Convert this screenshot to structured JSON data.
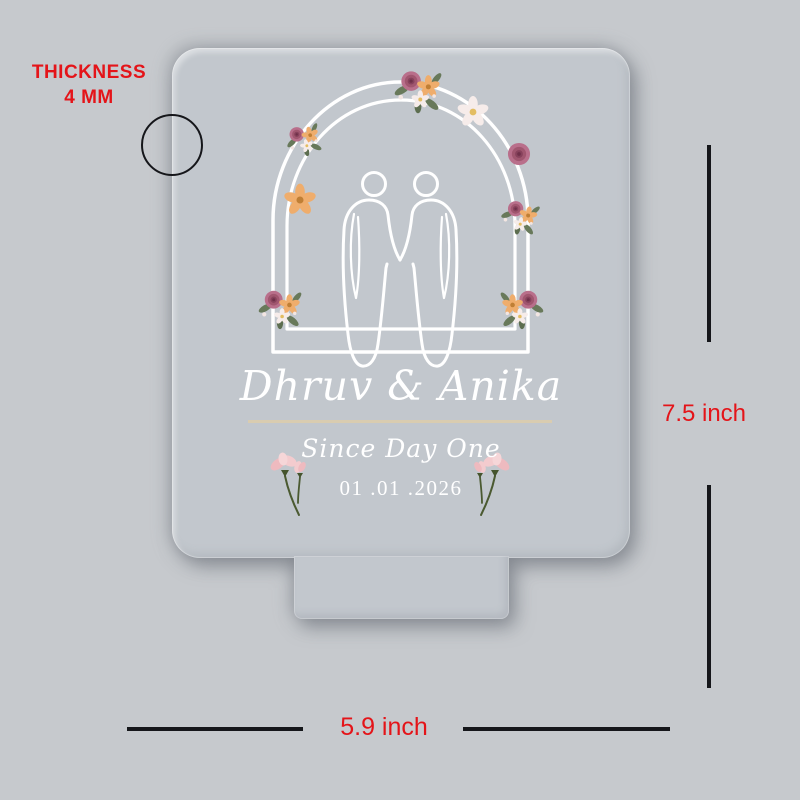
{
  "background_color": "#c6c9cd",
  "annotations": {
    "thickness": {
      "line1": "THICKNESS",
      "line2": "4 MM"
    },
    "height": "7.5 inch",
    "width": "5.9 inch",
    "label_color": "#e41419",
    "dimension_line_color": "#15161a"
  },
  "plaque": {
    "names": "Dhruv & Anika",
    "tagline": "Since Day One",
    "date": "01 .01 .2026",
    "engraving_color": "#ffffff",
    "divider_color": "#d9ccb0",
    "material_color": "#c2c7cd"
  },
  "icons": {
    "thickness-circle": "○ edge-thickness callout ring",
    "floral-arch": "double white wedding arch",
    "couple-silhouette": "two outlined figures holding hands",
    "flower-cluster": "✿ rose / peach / white blossom cluster",
    "flower-sprig": "❀ pink tulip sprig with green stem"
  }
}
